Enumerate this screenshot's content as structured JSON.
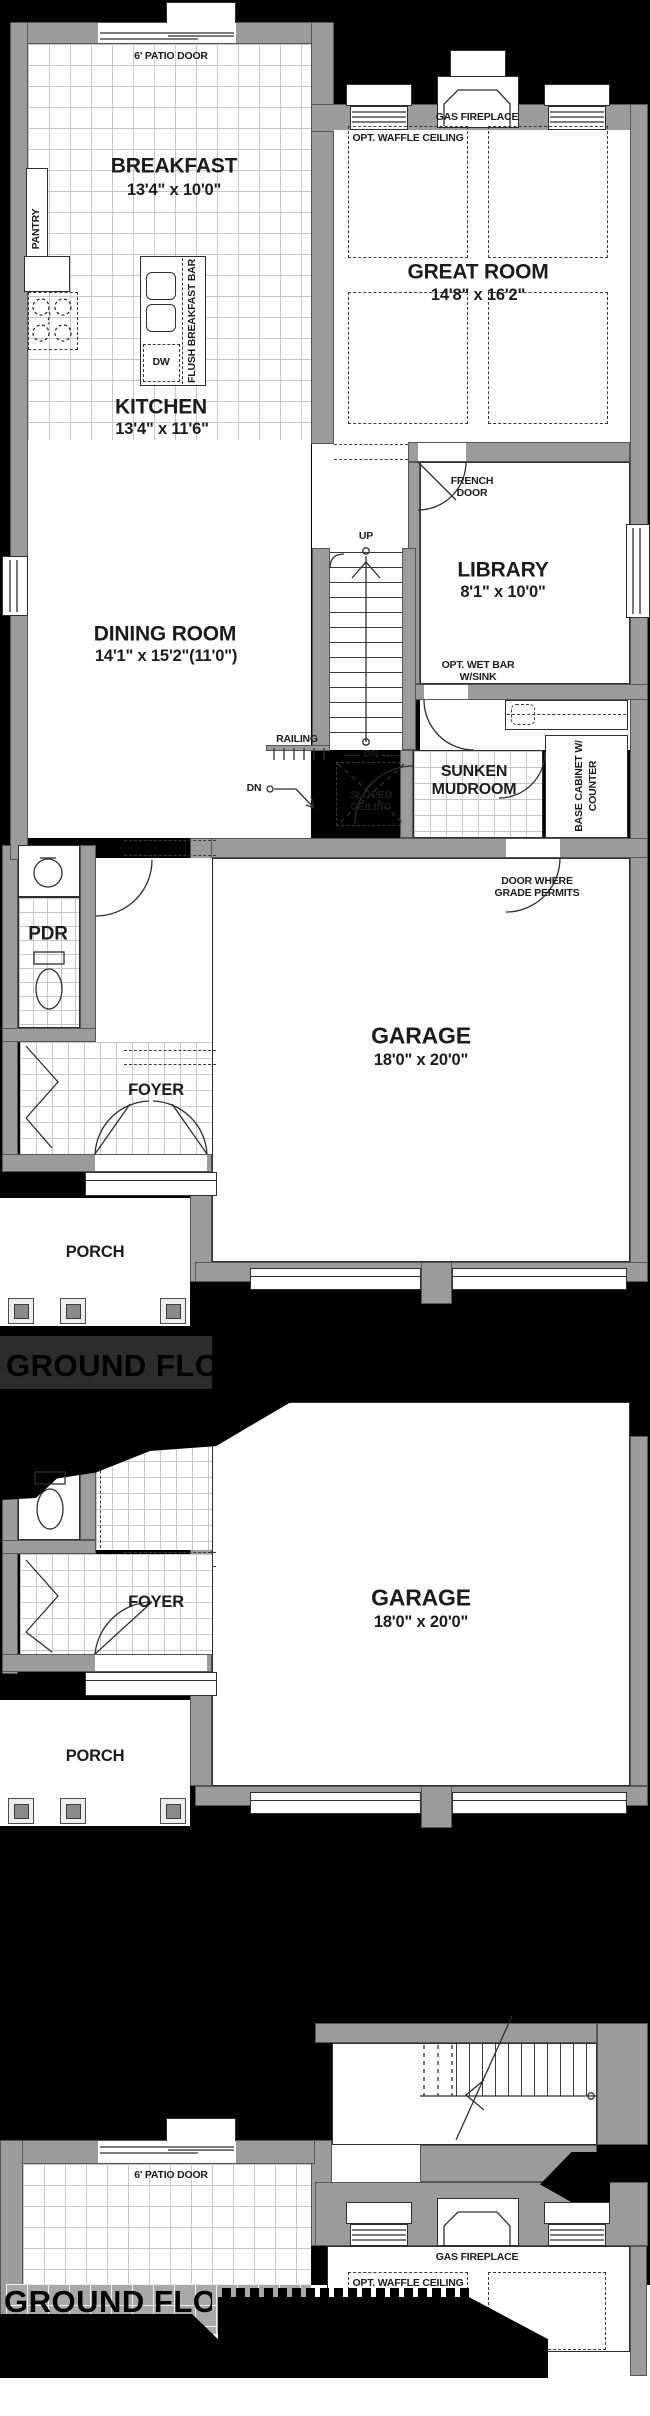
{
  "colors": {
    "background": "#000000",
    "wall": "#9b9b9b",
    "line": "#2e2e2e",
    "glitch_panel": "#2c2c2c"
  },
  "plan1": {
    "patio_door_label": "6' PATIO DOOR",
    "breakfast": {
      "name": "BREAKFAST",
      "dims": "13'4\" x 10'0\""
    },
    "pantry_label": "PANTRY",
    "gas_fireplace_label": "GAS FIREPLACE",
    "waffle_ceiling_label": "OPT. WAFFLE CEILING",
    "great_room": {
      "name": "GREAT ROOM",
      "dims": "14'8\" x 16'2\""
    },
    "kitchen": {
      "name": "KITCHEN",
      "dims": "13'4\" x 11'6\""
    },
    "dishwasher_label": "DW",
    "breakfast_bar_label": "FLUSH BREAKFAST BAR",
    "french_door": {
      "line1": "FRENCH",
      "line2": "DOOR"
    },
    "library": {
      "name": "LIBRARY",
      "dims": "8'1\" x 10'0\""
    },
    "stairs": {
      "up": "UP",
      "dn_upper": "DN",
      "dn_lower": "DN",
      "railing": "RAILING"
    },
    "dining_room": {
      "name": "DINING ROOM",
      "dims": "14'1\" x 15'2\"(11'0\")"
    },
    "wet_bar": {
      "line1": "OPT. WET BAR",
      "line2": "W/SINK"
    },
    "sloped_ceiling": {
      "line1": "SLOPED",
      "line2": "CEILING"
    },
    "sunken_mudroom": {
      "line1": "SUNKEN",
      "line2": "MUDROOM"
    },
    "base_cabinet": {
      "line1": "BASE CABINET W/",
      "line2": "COUNTER"
    },
    "grade_door": {
      "line1": "DOOR WHERE",
      "line2": "GRADE PERMITS"
    },
    "garage": {
      "name": "GARAGE",
      "dims": "18'0\" x 20'0\""
    },
    "pdr_label": "PDR",
    "foyer_label": "FOYER",
    "porch_label": "PORCH"
  },
  "plan2": {
    "obscured_title": "GROUND FLOOR",
    "foyer_label": "FOYER",
    "garage": {
      "name": "GARAGE",
      "dims": "18'0\" x 20'0\""
    },
    "porch_label": "PORCH"
  },
  "plan3": {
    "obscured_title": "GROUND FLOOR",
    "patio_door_label": "6' PATIO DOOR",
    "gas_fireplace_label": "GAS FIREPLACE",
    "waffle_ceiling_label": "OPT. WAFFLE CEILING"
  }
}
